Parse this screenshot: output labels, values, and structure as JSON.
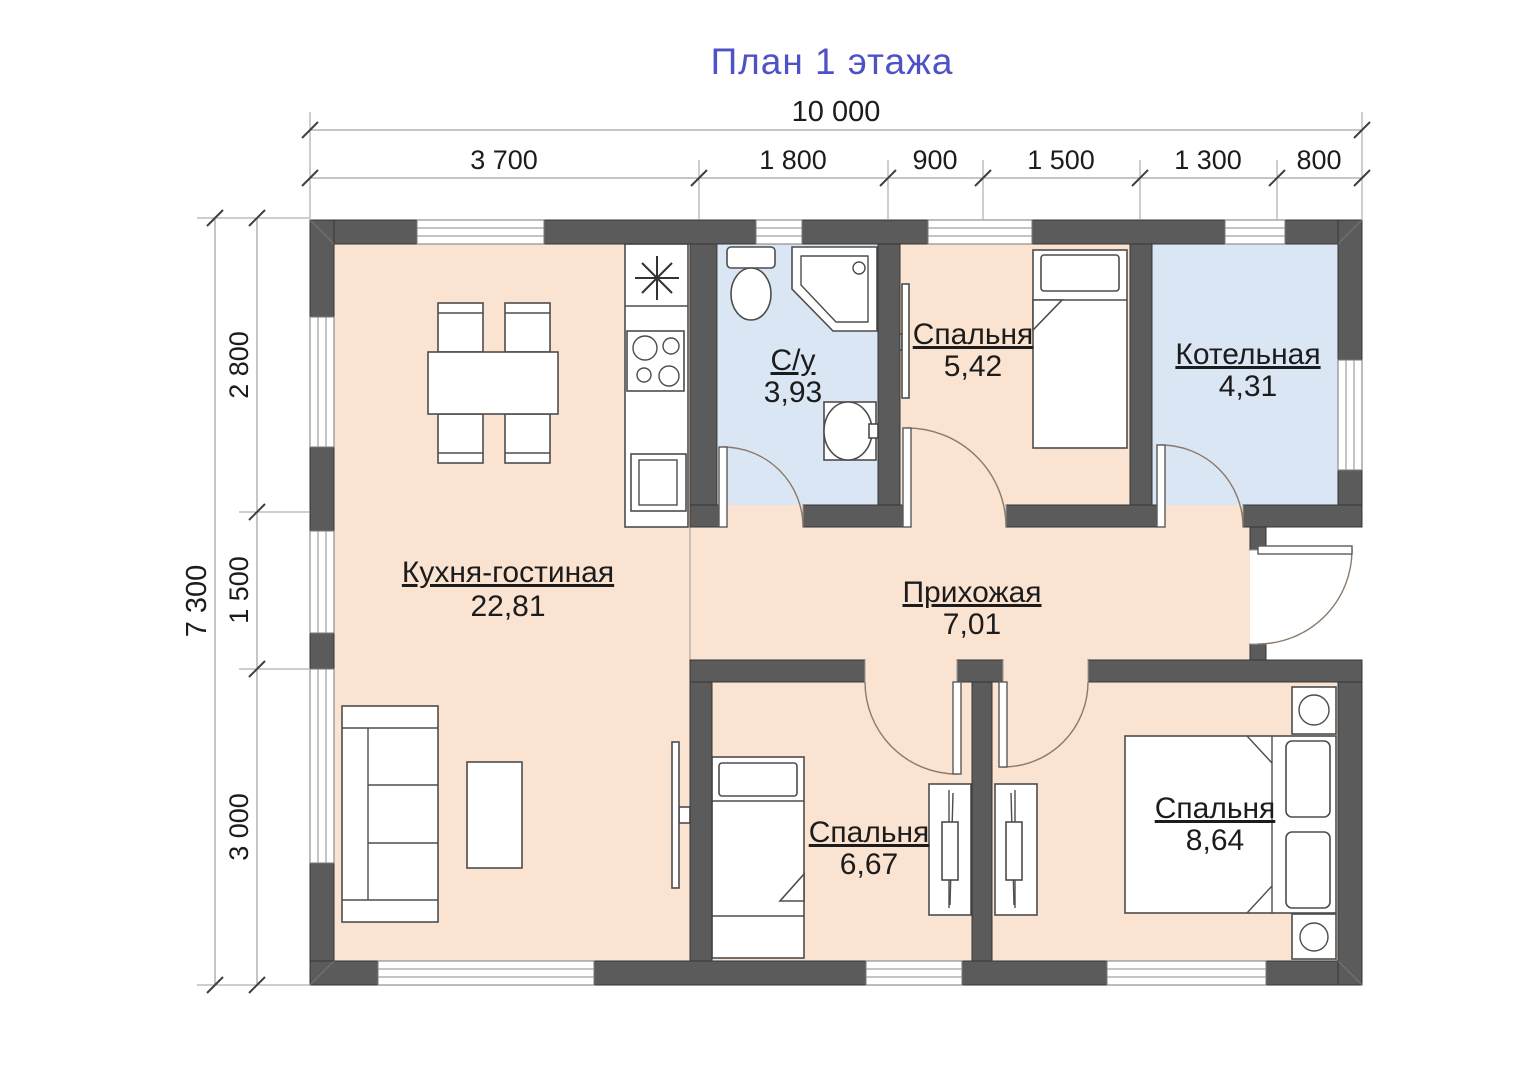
{
  "title": "План 1 этажа",
  "colors": {
    "title": "#4f51c6",
    "wall": "#5b5b5b",
    "floor_dry": "#fae3d1",
    "floor_wet": "#dbe6f5"
  },
  "symbols": {
    "kitchen_vent": "asterisk-star"
  },
  "dimensions": {
    "top_total": "10 000",
    "top_segments": [
      "3 700",
      "1 800",
      "900",
      "1 500",
      "1 300",
      "800"
    ],
    "left_total": "7 300",
    "left_segments": [
      "2 800",
      "1 500",
      "3 000"
    ]
  },
  "rooms": {
    "kitchen_living": {
      "name": "Кухня-гостиная",
      "area": "22,81"
    },
    "bathroom": {
      "name": "С/у",
      "area": "3,93"
    },
    "bedroom_top": {
      "name": "Спальня",
      "area": "5,42"
    },
    "boiler": {
      "name": "Котельная",
      "area": "4,31"
    },
    "hallway": {
      "name": "Прихожая",
      "area": "7,01"
    },
    "bedroom_small": {
      "name": "Спальня",
      "area": "6,67"
    },
    "bedroom_master": {
      "name": "Спальня",
      "area": "8,64"
    }
  }
}
